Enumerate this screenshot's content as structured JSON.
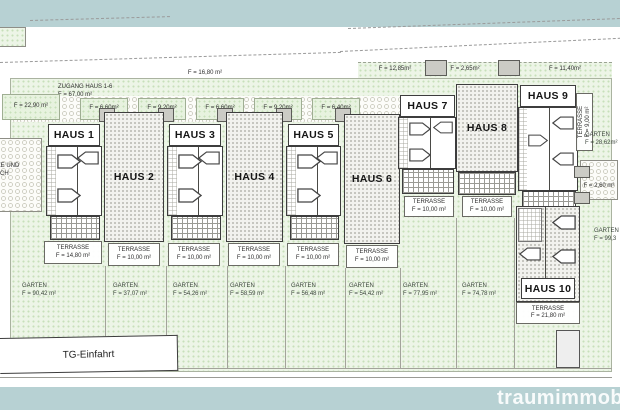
{
  "watermark": "traumimmobilien",
  "plan": {
    "tg_label": "TG-Einfahrt",
    "area_labels": {
      "upper": "F = 16,80 m²",
      "left_zone": "F = 22,90 m²",
      "zugang_line1": "ZUGANG HAUS 1-6",
      "zugang_line2": "F = 67,00 m²",
      "strip": [
        "F = 6,60m²",
        "F = 9,20m²",
        "F = 6,60m²",
        "F = 9,20m²",
        "F = 6,40m²"
      ],
      "right_strip": [
        "F = 12,85m²",
        "F = 2,65m²",
        "F = 11,40m²"
      ],
      "right_side": "F = 2,60 m²",
      "left_cut_line1": "LÄTZE UND",
      "left_cut_line2": "EREICH",
      "left_cut_line3": "0 m²"
    },
    "houses": [
      {
        "name": "HAUS 1"
      },
      {
        "name": "HAUS 2"
      },
      {
        "name": "HAUS 3"
      },
      {
        "name": "HAUS 4"
      },
      {
        "name": "HAUS 5"
      },
      {
        "name": "HAUS 6"
      },
      {
        "name": "HAUS 7"
      },
      {
        "name": "HAUS 8"
      },
      {
        "name": "HAUS 9"
      },
      {
        "name": "HAUS 10"
      }
    ],
    "terraces": [
      {
        "title": "TERRASSE",
        "area": "F = 14,80 m²"
      },
      {
        "title": "TERRASSE",
        "area": "F = 10,00 m²"
      },
      {
        "title": "TERRASSE",
        "area": "F = 10,00 m²"
      },
      {
        "title": "TERRASSE",
        "area": "F = 10,00 m²"
      },
      {
        "title": "TERRASSE",
        "area": "F = 10,00 m²"
      },
      {
        "title": "TERRASSE",
        "area": "F = 10,00 m²"
      },
      {
        "title": "TERRASSE",
        "area": "F = 10,00 m²"
      },
      {
        "title": "TERRASSE",
        "area": "F = 10,00 m²"
      },
      {
        "title": "TERRASSE",
        "area": "F = 9,00 m²"
      },
      {
        "title": "TERRASSE",
        "area": "F = 21,80 m²"
      }
    ],
    "gardens": [
      {
        "title": "GARTEN",
        "area": "F = 90,42 m²"
      },
      {
        "title": "GARTEN",
        "area": "F = 37,07 m²"
      },
      {
        "title": "GARTEN",
        "area": "F = 54,26 m²"
      },
      {
        "title": "GARTEN",
        "area": "F = 58,59 m²"
      },
      {
        "title": "GARTEN",
        "area": "F = 56,48 m²"
      },
      {
        "title": "GARTEN",
        "area": "F = 54,42 m²"
      },
      {
        "title": "GARTEN",
        "area": "F = 77,95 m²"
      },
      {
        "title": "GARTEN",
        "area": "F = 74,78 m²"
      },
      {
        "title": "GARTEN",
        "area": "F = 28,62m²"
      },
      {
        "title": "GARTEN",
        "area": "F = 99,3"
      }
    ],
    "colors": {
      "band": "#b7d1d3",
      "green": "#edf5e7",
      "house_fill": "#f2f2ee",
      "line": "#3d3d3d"
    }
  }
}
